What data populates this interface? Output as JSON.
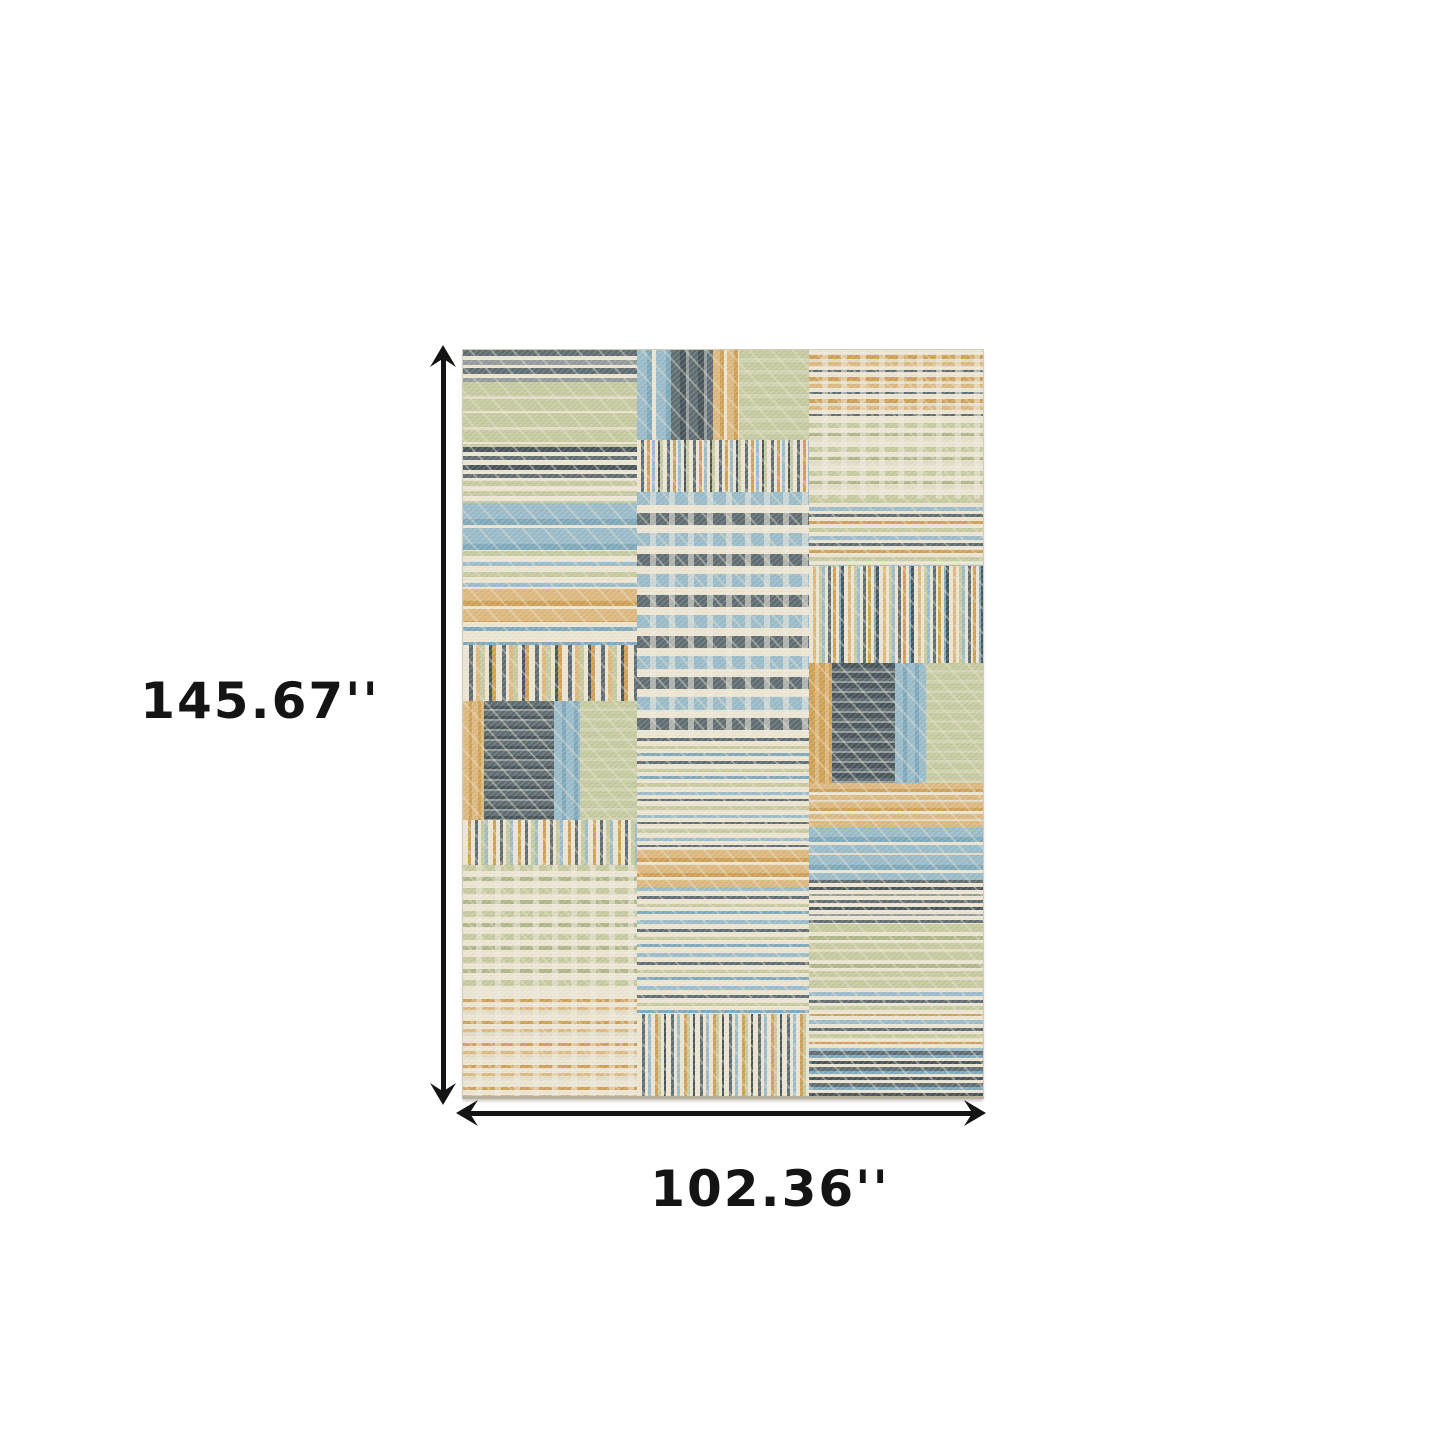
{
  "diagram": {
    "type": "product-dimension-diagram",
    "subject": "patchwork-stripe-area-rug"
  },
  "dimensions": {
    "height_label": "145.67''",
    "width_label": "102.36''"
  },
  "colors": {
    "background": "#ffffff",
    "arrow": "#141414",
    "text": "#141414",
    "rug_base": "#ece5d2",
    "rug": {
      "cream": "#ece5d2",
      "cream2": "#e2dbc5",
      "white": "#f3eee1",
      "sage": "#c6caa0",
      "sage2": "#afb789",
      "sageL": "#d2d4b2",
      "blue": "#9abcca",
      "blue2": "#7fa9bb",
      "slate": "#5f6d72",
      "slate2": "#47545a",
      "gray": "#939c9b",
      "tan": "#ddb87f",
      "gold": "#cfa055"
    }
  },
  "rug": {
    "patches": [
      {
        "x": 0,
        "y": 0,
        "w": 33.5,
        "h": 4.3,
        "dir": "h",
        "stripes": [
          [
            "slate",
            6
          ],
          [
            "cream",
            4
          ],
          [
            "gray",
            5
          ],
          [
            "cream",
            3
          ]
        ]
      },
      {
        "x": 0,
        "y": 4.3,
        "w": 33.5,
        "h": 8.7,
        "dir": "h",
        "stripes": [
          [
            "sage",
            14
          ],
          [
            "cream2",
            3
          ],
          [
            "sage",
            12
          ],
          [
            "cream",
            2
          ]
        ]
      },
      {
        "x": 0,
        "y": 13,
        "w": 33.5,
        "h": 4.5,
        "dir": "h",
        "stripes": [
          [
            "slate2",
            5
          ],
          [
            "cream",
            4
          ],
          [
            "slate",
            4
          ],
          [
            "cream",
            5
          ]
        ]
      },
      {
        "x": 0,
        "y": 17.5,
        "w": 33.5,
        "h": 3,
        "dir": "h",
        "stripes": [
          [
            "sage",
            5
          ],
          [
            "cream",
            5
          ]
        ]
      },
      {
        "x": 0,
        "y": 20.5,
        "w": 33.5,
        "h": 6.5,
        "dir": "h",
        "stripes": [
          [
            "blue",
            16
          ],
          [
            "blue2",
            6
          ],
          [
            "cream",
            3
          ]
        ]
      },
      {
        "x": 0,
        "y": 27,
        "w": 33.5,
        "h": 5,
        "dir": "h",
        "stripes": [
          [
            "sage",
            5
          ],
          [
            "cream",
            6
          ],
          [
            "blue",
            4
          ],
          [
            "cream",
            6
          ]
        ]
      },
      {
        "x": 0,
        "y": 32,
        "w": 33.5,
        "h": 4.5,
        "dir": "h",
        "stripes": [
          [
            "tan",
            12
          ],
          [
            "gold",
            5
          ],
          [
            "cream",
            3
          ]
        ]
      },
      {
        "x": 0,
        "y": 36.5,
        "w": 33.5,
        "h": 3,
        "dir": "h",
        "stripes": [
          [
            "cream",
            5
          ],
          [
            "blue2",
            4
          ],
          [
            "cream",
            6
          ]
        ]
      },
      {
        "x": 0,
        "y": 39.5,
        "w": 33.5,
        "h": 7.5,
        "dir": "v",
        "stripes": [
          [
            "cream",
            6
          ],
          [
            "slate",
            4
          ],
          [
            "cream",
            3
          ],
          [
            "tan",
            4
          ],
          [
            "sage",
            5
          ],
          [
            "cream",
            4
          ],
          [
            "slate2",
            3
          ],
          [
            "gold",
            4
          ]
        ]
      },
      {
        "x": 0,
        "y": 47,
        "w": 4,
        "h": 16,
        "dir": "v",
        "stripes": [
          [
            "tan",
            6
          ],
          [
            "gold",
            3
          ]
        ]
      },
      {
        "x": 4,
        "y": 47,
        "w": 13.5,
        "h": 16,
        "dir": "h",
        "stripes": [
          [
            "slate",
            5
          ],
          [
            "slate2",
            3
          ],
          [
            "gray",
            2
          ]
        ]
      },
      {
        "x": 17.5,
        "y": 47,
        "w": 5,
        "h": 16,
        "dir": "v",
        "stripes": [
          [
            "blue",
            8
          ],
          [
            "blue2",
            4
          ]
        ]
      },
      {
        "x": 22.5,
        "y": 47,
        "w": 11,
        "h": 16,
        "dir": "h",
        "stripes": [
          [
            "sage",
            7
          ],
          [
            "sageL",
            3
          ]
        ]
      },
      {
        "x": 0,
        "y": 63,
        "w": 33.5,
        "h": 6,
        "dir": "v",
        "stripes": [
          [
            "cream",
            5
          ],
          [
            "gold",
            3
          ],
          [
            "cream",
            4
          ],
          [
            "slate",
            3
          ],
          [
            "cream",
            3
          ],
          [
            "sage",
            4
          ],
          [
            "blue",
            3
          ]
        ]
      },
      {
        "x": 0,
        "y": 69,
        "w": 33.5,
        "h": 17,
        "dir": "h",
        "plaid": true,
        "stripes": [
          [
            "sage",
            6
          ],
          [
            "cream",
            6
          ],
          [
            "sage2",
            4
          ],
          [
            "cream",
            7
          ]
        ]
      },
      {
        "x": 0,
        "y": 86,
        "w": 33.5,
        "h": 14,
        "dir": "h",
        "plaid": true,
        "stripes": [
          [
            "cream",
            7
          ],
          [
            "gold",
            3
          ],
          [
            "cream",
            5
          ],
          [
            "tan",
            3
          ],
          [
            "cream2",
            4
          ]
        ]
      },
      {
        "x": 33.5,
        "y": 0,
        "w": 6.5,
        "h": 12,
        "dir": "v",
        "stripes": [
          [
            "blue",
            10
          ],
          [
            "blue2",
            5
          ],
          [
            "cream",
            4
          ]
        ]
      },
      {
        "x": 40,
        "y": 0,
        "w": 8,
        "h": 12,
        "dir": "v",
        "stripes": [
          [
            "slate",
            9
          ],
          [
            "slate2",
            6
          ],
          [
            "gray",
            3
          ]
        ]
      },
      {
        "x": 48,
        "y": 0,
        "w": 5,
        "h": 12,
        "dir": "v",
        "stripes": [
          [
            "tan",
            7
          ],
          [
            "gold",
            4
          ],
          [
            "cream",
            3
          ]
        ]
      },
      {
        "x": 53,
        "y": 0,
        "w": 13.5,
        "h": 12,
        "dir": "h",
        "stripes": [
          [
            "sage",
            8
          ],
          [
            "sageL",
            4
          ]
        ]
      },
      {
        "x": 33.5,
        "y": 12,
        "w": 33,
        "h": 7,
        "dir": "v",
        "stripes": [
          [
            "cream",
            4
          ],
          [
            "slate",
            3
          ],
          [
            "cream",
            3
          ],
          [
            "gold",
            3
          ],
          [
            "cream",
            2
          ],
          [
            "blue",
            3
          ],
          [
            "cream",
            3
          ],
          [
            "slate2",
            2
          ],
          [
            "sage",
            3
          ]
        ]
      },
      {
        "x": 33.5,
        "y": 19,
        "w": 33,
        "h": 33,
        "dir": "h",
        "plaid": true,
        "stripes": [
          [
            "blue",
            13
          ],
          [
            "cream",
            8
          ],
          [
            "slate",
            12
          ],
          [
            "cream",
            8
          ]
        ]
      },
      {
        "x": 33.5,
        "y": 52,
        "w": 33,
        "h": 6,
        "dir": "h",
        "stripes": [
          [
            "slate",
            3
          ],
          [
            "cream",
            5
          ],
          [
            "sage",
            3
          ],
          [
            "cream",
            4
          ],
          [
            "blue2",
            3
          ],
          [
            "cream",
            5
          ]
        ]
      },
      {
        "x": 33.5,
        "y": 58,
        "w": 33,
        "h": 9,
        "dir": "h",
        "stripes": [
          [
            "sage",
            4
          ],
          [
            "cream",
            5
          ],
          [
            "blue",
            3
          ],
          [
            "cream",
            4
          ],
          [
            "slate",
            2
          ],
          [
            "cream",
            5
          ]
        ]
      },
      {
        "x": 33.5,
        "y": 67,
        "w": 33,
        "h": 5,
        "dir": "h",
        "stripes": [
          [
            "tan",
            8
          ],
          [
            "gold",
            4
          ],
          [
            "cream",
            3
          ]
        ]
      },
      {
        "x": 33.5,
        "y": 72,
        "w": 33,
        "h": 17,
        "dir": "h",
        "stripes": [
          [
            "blue",
            4
          ],
          [
            "cream",
            5
          ],
          [
            "slate",
            3
          ],
          [
            "cream",
            5
          ],
          [
            "sage",
            3
          ],
          [
            "cream",
            4
          ],
          [
            "blue2",
            3
          ],
          [
            "cream",
            6
          ]
        ]
      },
      {
        "x": 33.5,
        "y": 89,
        "w": 33,
        "h": 11,
        "dir": "v",
        "stripes": [
          [
            "cream",
            5
          ],
          [
            "slate",
            3
          ],
          [
            "cream",
            3
          ],
          [
            "blue",
            3
          ],
          [
            "cream",
            4
          ],
          [
            "gold",
            3
          ],
          [
            "sage",
            3
          ],
          [
            "cream",
            3
          ],
          [
            "slate2",
            2
          ]
        ]
      },
      {
        "x": 66.5,
        "y": 0,
        "w": 33.5,
        "h": 9,
        "dir": "h",
        "plaid": true,
        "stripes": [
          [
            "cream",
            5
          ],
          [
            "gold",
            4
          ],
          [
            "cream2",
            3
          ],
          [
            "tan",
            4
          ],
          [
            "cream",
            4
          ],
          [
            "slate",
            2
          ]
        ]
      },
      {
        "x": 66.5,
        "y": 9,
        "w": 33.5,
        "h": 11,
        "dir": "h",
        "plaid": true,
        "stripes": [
          [
            "cream",
            6
          ],
          [
            "sage",
            5
          ],
          [
            "cream",
            5
          ],
          [
            "sage2",
            3
          ],
          [
            "cream2",
            5
          ]
        ]
      },
      {
        "x": 66.5,
        "y": 20,
        "w": 33.5,
        "h": 9,
        "dir": "h",
        "stripes": [
          [
            "sage",
            4
          ],
          [
            "cream",
            4
          ],
          [
            "blue",
            4
          ],
          [
            "cream",
            3
          ],
          [
            "slate",
            3
          ],
          [
            "cream",
            4
          ],
          [
            "gold",
            3
          ],
          [
            "cream",
            4
          ]
        ]
      },
      {
        "x": 66.5,
        "y": 29,
        "w": 33.5,
        "h": 13,
        "dir": "v",
        "stripes": [
          [
            "cream",
            4
          ],
          [
            "tan",
            3
          ],
          [
            "cream",
            3
          ],
          [
            "sage",
            3
          ],
          [
            "blue",
            3
          ],
          [
            "cream",
            3
          ],
          [
            "slate",
            3
          ],
          [
            "cream",
            2
          ],
          [
            "gold",
            3
          ],
          [
            "cream",
            3
          ],
          [
            "blue2",
            2
          ],
          [
            "slate2",
            3
          ]
        ]
      },
      {
        "x": 66.5,
        "y": 42,
        "w": 4.5,
        "h": 16,
        "dir": "v",
        "stripes": [
          [
            "gold",
            6
          ],
          [
            "tan",
            4
          ]
        ]
      },
      {
        "x": 71,
        "y": 42,
        "w": 12,
        "h": 16,
        "dir": "h",
        "stripes": [
          [
            "slate2",
            5
          ],
          [
            "slate",
            3
          ],
          [
            "gray",
            2
          ]
        ]
      },
      {
        "x": 83,
        "y": 42,
        "w": 6,
        "h": 16,
        "dir": "v",
        "stripes": [
          [
            "blue",
            8
          ],
          [
            "blue2",
            4
          ]
        ]
      },
      {
        "x": 89,
        "y": 42,
        "w": 11,
        "h": 16,
        "dir": "h",
        "stripes": [
          [
            "sage",
            7
          ],
          [
            "sageL",
            3
          ]
        ]
      },
      {
        "x": 66.5,
        "y": 58,
        "w": 33.5,
        "h": 6,
        "dir": "h",
        "stripes": [
          [
            "tan",
            6
          ],
          [
            "gold",
            3
          ],
          [
            "cream",
            3
          ],
          [
            "tan",
            5
          ],
          [
            "cream2",
            2
          ]
        ]
      },
      {
        "x": 66.5,
        "y": 64,
        "w": 33.5,
        "h": 7,
        "dir": "h",
        "stripes": [
          [
            "blue",
            10
          ],
          [
            "blue2",
            5
          ],
          [
            "cream",
            3
          ],
          [
            "blue",
            8
          ],
          [
            "cream2",
            2
          ]
        ]
      },
      {
        "x": 66.5,
        "y": 71,
        "w": 33.5,
        "h": 6,
        "dir": "h",
        "stripes": [
          [
            "slate",
            3
          ],
          [
            "cream",
            4
          ],
          [
            "slate2",
            3
          ],
          [
            "cream",
            4
          ],
          [
            "gray",
            2
          ],
          [
            "cream",
            4
          ]
        ]
      },
      {
        "x": 66.5,
        "y": 77,
        "w": 33.5,
        "h": 9,
        "dir": "h",
        "stripes": [
          [
            "sage",
            8
          ],
          [
            "cream",
            4
          ],
          [
            "sage2",
            4
          ],
          [
            "cream",
            3
          ],
          [
            "sage",
            6
          ],
          [
            "cream2",
            3
          ]
        ]
      },
      {
        "x": 66.5,
        "y": 86,
        "w": 33.5,
        "h": 8,
        "dir": "h",
        "stripes": [
          [
            "blue",
            4
          ],
          [
            "cream",
            4
          ],
          [
            "slate",
            3
          ],
          [
            "cream",
            3
          ],
          [
            "sage",
            4
          ],
          [
            "cream",
            4
          ],
          [
            "gold",
            2
          ],
          [
            "cream",
            4
          ]
        ]
      },
      {
        "x": 66.5,
        "y": 94,
        "w": 33.5,
        "h": 6,
        "dir": "h",
        "stripes": [
          [
            "slate",
            4
          ],
          [
            "blue2",
            3
          ],
          [
            "cream",
            3
          ],
          [
            "slate2",
            3
          ],
          [
            "cream",
            3
          ]
        ]
      }
    ]
  }
}
